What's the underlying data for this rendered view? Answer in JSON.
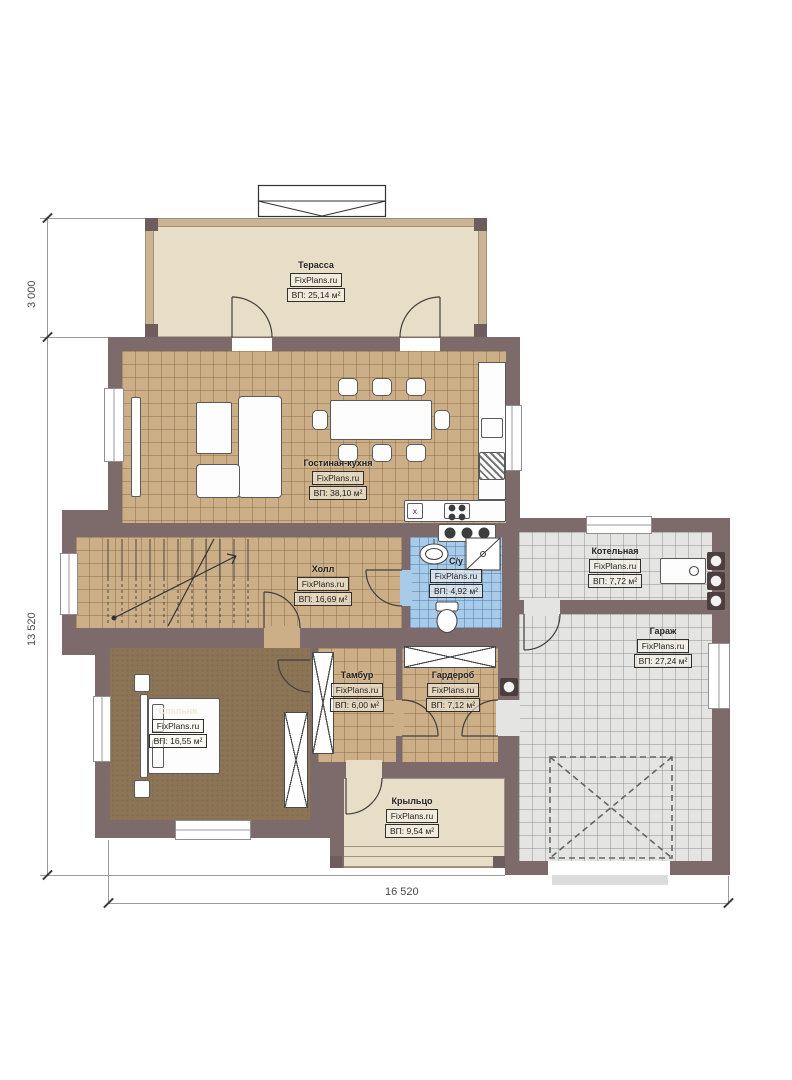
{
  "plan": {
    "brand": "FixPlans.ru",
    "rooms": {
      "terrace": {
        "name": "Терасса",
        "area": "ВП: 25,14 м²"
      },
      "living": {
        "name": "Гостиная-кухня",
        "area": "ВП: 38,10 м²"
      },
      "hall": {
        "name": "Холл",
        "area": "ВП: 16,69 м²"
      },
      "bathroom": {
        "name": "С/у",
        "area": "ВП: 4,92 м²"
      },
      "boiler": {
        "name": "Котельная",
        "area": "ВП: 7,72 м²"
      },
      "garage": {
        "name": "Гараж",
        "area": "ВП: 27,24 м²"
      },
      "bedroom": {
        "name": "Спальня",
        "area": "ВП: 16,55 м²"
      },
      "tambour": {
        "name": "Тамбур",
        "area": "ВП: 6,00 м²"
      },
      "wardrobe": {
        "name": "Гардероб",
        "area": "ВП: 7,12 м²"
      },
      "porch": {
        "name": "Крыльцо",
        "area": "ВП: 9,54 м²"
      }
    },
    "dimensions": {
      "left_top": "3 000",
      "left_side": "13 520",
      "bottom": "16 520"
    },
    "kitchen_marker": "x",
    "colors": {
      "wall": "#7D6B6C",
      "floor_tan": "#CDAF87",
      "floor_blue": "#A9CBEA",
      "floor_gray": "#E4E4E2",
      "floor_bedroom": "#8C7457",
      "floor_beige": "#E8DDC7"
    }
  }
}
